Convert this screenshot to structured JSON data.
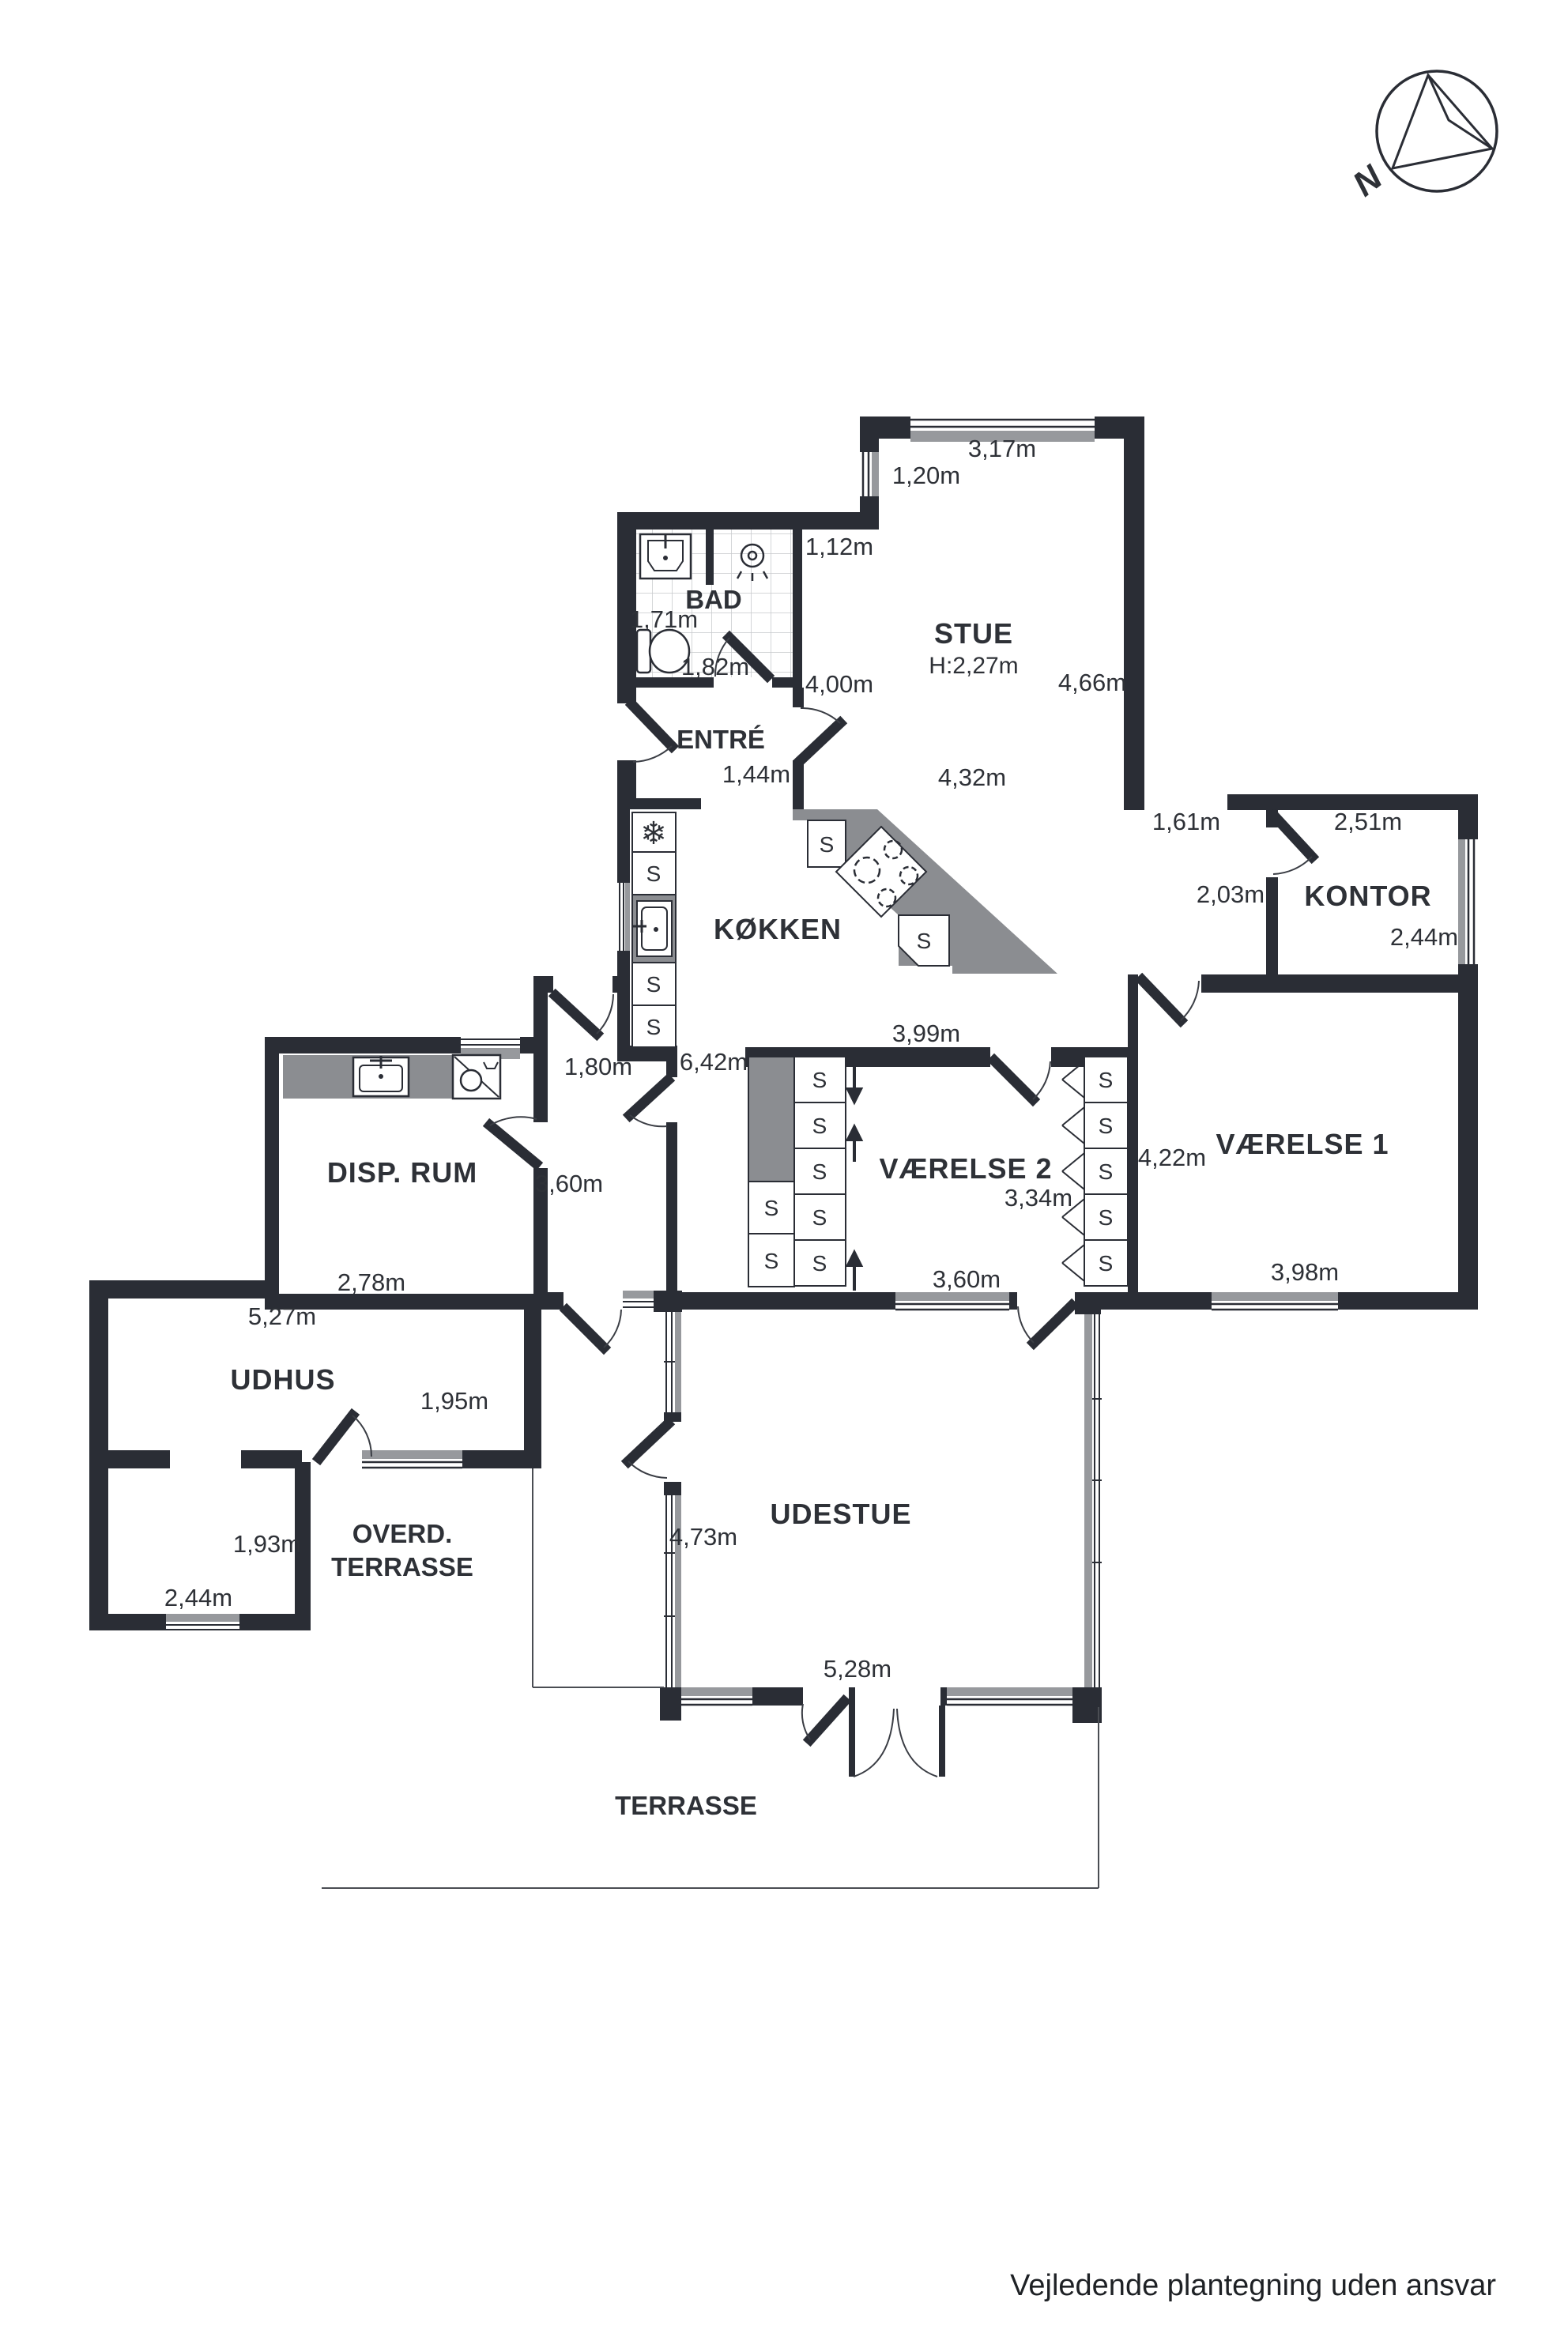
{
  "compass": {
    "label": "N"
  },
  "rooms": {
    "stue": {
      "name": "STUE",
      "ceiling_height": "H:2,27m",
      "dim_top": "3,17m",
      "dim_upper_left": "1,20m",
      "dim_bad_side": "1,12m",
      "dim_west": "4,00m",
      "dim_width": "4,32m",
      "dim_east": "4,66m"
    },
    "bad": {
      "name": "BAD",
      "dim_width": "1,71m",
      "dim_depth": "1,82m"
    },
    "entre": {
      "name": "ENTRÉ",
      "dim_opening": "1,44m"
    },
    "kokken": {
      "name": "KØKKEN",
      "dim_south": "3,99m"
    },
    "gang": {
      "dim_length": "6,42m",
      "dim_width": "1,80m",
      "dim_south": "3,60m"
    },
    "kontor": {
      "name": "KONTOR",
      "dim_window": "1,61m",
      "dim_north": "2,51m",
      "dim_west": "2,03m",
      "dim_east": "2,44m"
    },
    "vaerelse1": {
      "name": "VÆRELSE 1",
      "dim_west": "4,22m",
      "dim_south": "3,98m"
    },
    "vaerelse2": {
      "name": "VÆRELSE 2",
      "dim_width": "3,34m",
      "dim_window": "3,60m"
    },
    "disp_rum": {
      "name": "DISP. RUM",
      "dim_south": "2,78m"
    },
    "udhus": {
      "name": "UDHUS",
      "dim_north": "5,27m",
      "dim_east": "1,95m"
    },
    "udhus_annex": {
      "dim_east": "1,93m",
      "dim_south": "2,44m"
    },
    "overdaekket_terrasse": {
      "name_line1": "OVERD.",
      "name_line2": "TERRASSE"
    },
    "udestue": {
      "name": "UDESTUE",
      "dim_west": "4,73m",
      "dim_south": "5,28m"
    },
    "terrasse": {
      "name": "TERRASSE"
    }
  },
  "symbols": {
    "cabinet": "S"
  },
  "footer": {
    "disclaimer": "Vejledende plantegning uden ansvar"
  }
}
